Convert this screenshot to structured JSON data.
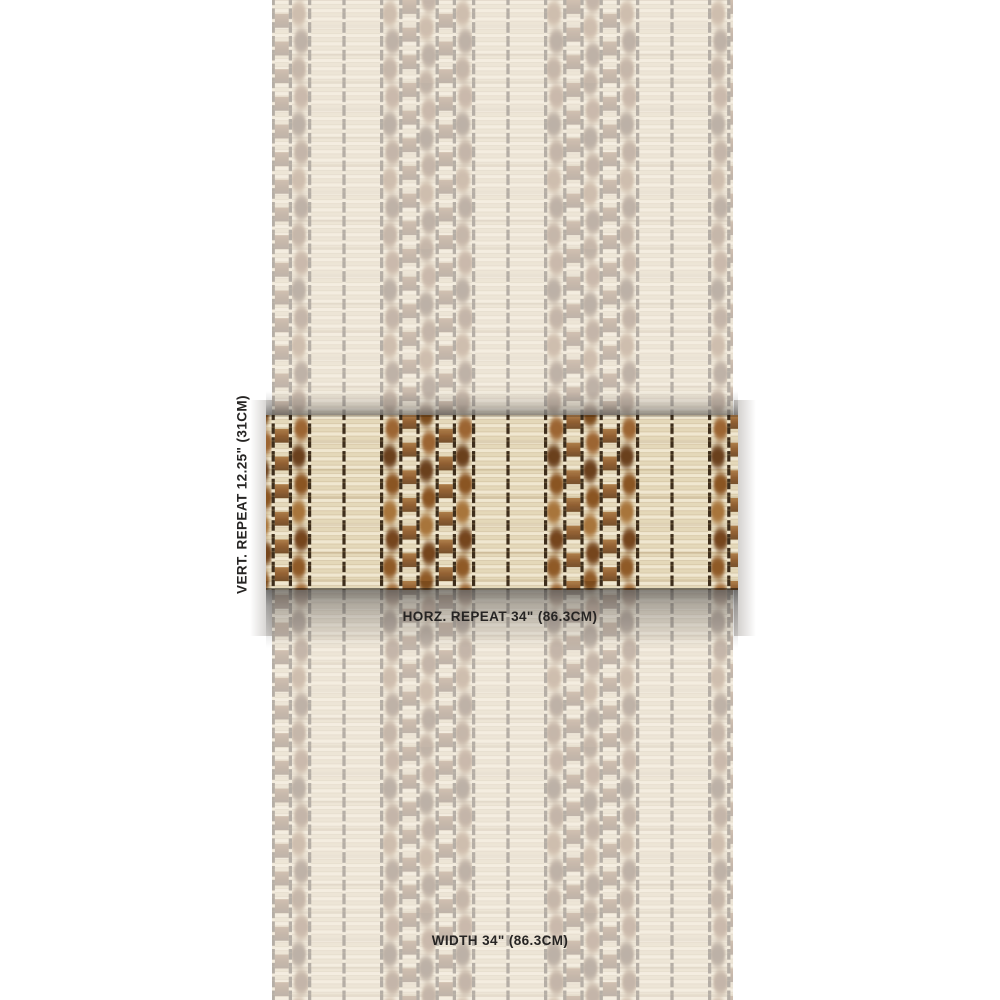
{
  "swatch": {
    "vertical_repeat_label": "VERT. REPEAT 12.25\" (31CM)",
    "horizontal_repeat_label": "HORZ. REPEAT 34\" (86.3CM)",
    "width_label": "WIDTH 34\" (86.3CM)"
  },
  "palette": {
    "page-bg": "#ffffff",
    "label-text": "#262423",
    "cream-ground": "#ece1c6",
    "slat-highlight": "#f0e7d0",
    "slat-shadow": "#c9b795",
    "warp-dark": "#3e2e1c",
    "warp-dash": "#efe5cb",
    "ikat-brown": "#8a5524",
    "ikat-dark": "#6b3f1a",
    "ikat-rust": "#a8743a",
    "checker-brown-light": "#aa7740",
    "checker-brown-dark": "#6d4520",
    "faded-tint": "#f0ebdf"
  }
}
